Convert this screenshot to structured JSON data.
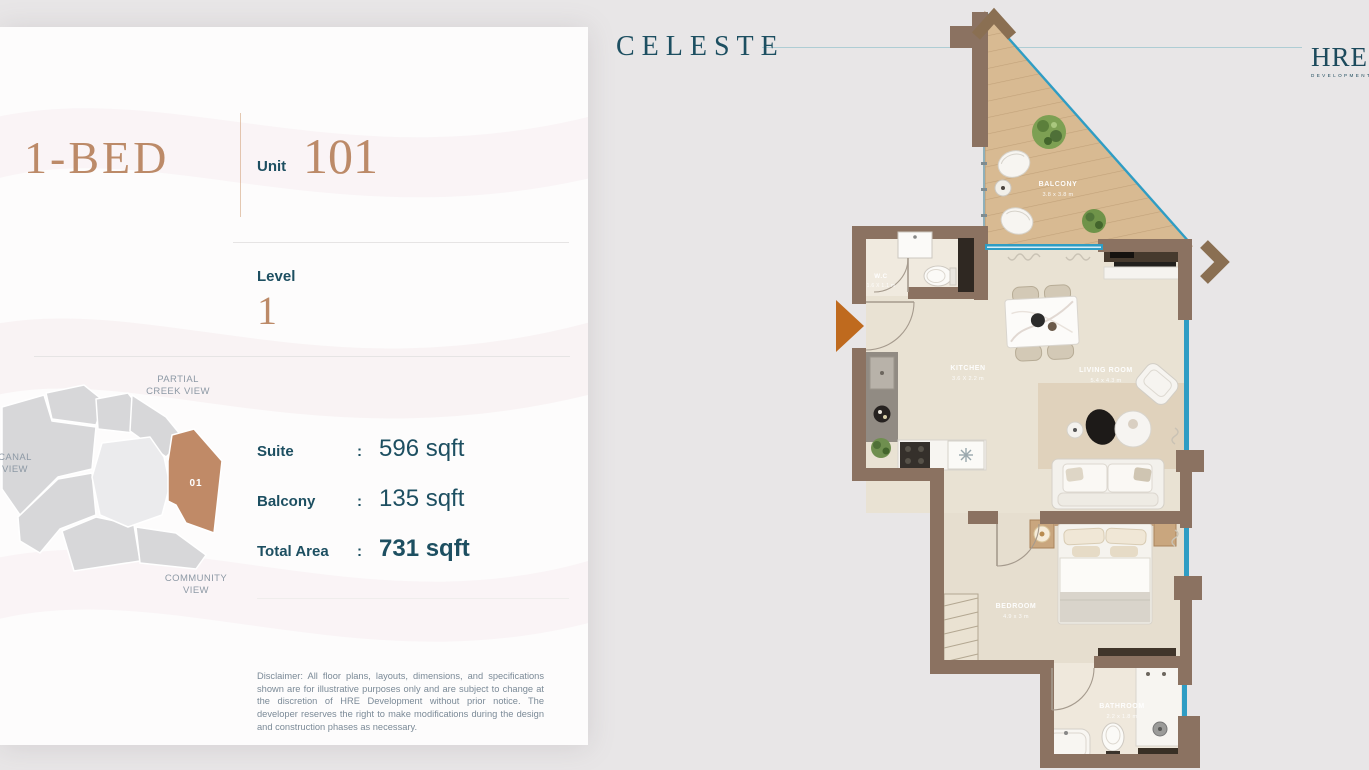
{
  "brand": {
    "logo": "CELESTE",
    "developer": {
      "name": "HRE",
      "subtitle": "DEVELOPMENT"
    }
  },
  "panel": {
    "unit_type": "1-BED",
    "unit": {
      "label": "Unit",
      "number": "101"
    },
    "level": {
      "label": "Level",
      "value": "1"
    },
    "areas": [
      {
        "label": "Suite",
        "separator": ":",
        "value": "596 sqft"
      },
      {
        "label": "Balcony",
        "separator": ":",
        "value": "135 sqft"
      },
      {
        "label": "Total Area",
        "separator": ":",
        "value": "731 sqft"
      }
    ],
    "site_map": {
      "highlighted_unit": "01",
      "labels": {
        "top_line1": "PARTIAL",
        "top_line2": "CREEK VIEW",
        "left_line1": "CANAL",
        "left_line2": "VIEW",
        "bottom_line1": "COMMUNITY",
        "bottom_line2": "VIEW"
      }
    },
    "disclaimer": "Disclaimer: All floor plans, layouts, dimensions, and specifications shown are for illustrative purposes only and are subject to change at the discretion of HRE Development without prior notice. The developer reserves the right to make modifications during the design and construction phases as necessary."
  },
  "floorplan": {
    "rooms": [
      {
        "name": "BALCONY",
        "dims": "3.8 x 3.8 m"
      },
      {
        "name": "W.C",
        "dims": "1.6 X 1.1 m"
      },
      {
        "name": "KITCHEN",
        "dims": "3.6 X 2.2 m"
      },
      {
        "name": "LIVING ROOM",
        "dims": "5.4 x 4.3 m"
      },
      {
        "name": "BEDROOM",
        "dims": "4.9 x 3 m"
      },
      {
        "name": "BATHROOM",
        "dims": "2.2 x 1.8 m"
      }
    ]
  },
  "colors": {
    "accent_tan": "#bc8a68",
    "teal": "#1d4f61",
    "wall_brown": "#8b7261",
    "glass_blue": "#2f9dc4",
    "entry_arrow_orange": "#bf6a1e",
    "background": "#e8e6e7",
    "card": "#fdfcfc"
  }
}
